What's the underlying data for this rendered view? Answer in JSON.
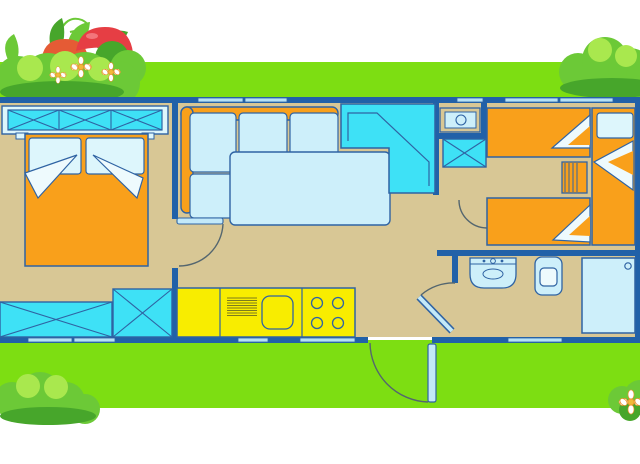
{
  "scene": {
    "kind": "cartoon-floorplan-illustration",
    "subject": "mobile-home-holiday-accommodation-plan",
    "canvas": {
      "width": 640,
      "height": 464
    }
  },
  "colors": {
    "background": "#ffffff",
    "grass": "#7dde12",
    "floor": "#d8c795",
    "wall": "#2161a8",
    "outline": "#2f63a3",
    "orange": "#f9a01b",
    "cyan": "#3ee1f6",
    "softcyan": "#cdeffa",
    "pillow": "#ddf6fc",
    "blanket": "#eefafd",
    "yellow": "#f8ed00",
    "window": "#b5e2f6",
    "doorleaf": "#c3e9f8",
    "arc": "#54666f",
    "drainer": "#7c7c1e",
    "bushdark": "#47a62b",
    "bushmid": "#6cc937",
    "bushlight": "#a9e84e",
    "mushred": "#e63e44",
    "mushred2": "#e55b35",
    "mushstem": "#f2ecca",
    "daisycenter": "#f0b93b",
    "daisyring": "#e8912b",
    "white": "#ffffff"
  },
  "legend": {
    "rooms": [
      "double-bedroom",
      "living-room",
      "kitchen",
      "hallway",
      "bathroom",
      "twin-bedroom"
    ],
    "furniture": [
      "overhead-wardrobe",
      "double-bed",
      "pillows",
      "wardrobe-cabinets",
      "corner-sofa",
      "sofa-cushions",
      "dining-table",
      "angular-kitchen-unit",
      "water-heater-closet",
      "cross-cabinet",
      "kitchen-counter",
      "drainer",
      "kitchen-sink",
      "hob-burners",
      "washbasin",
      "toilet",
      "shower",
      "twin-beds",
      "nightstand",
      "entry-door",
      "interior-doors",
      "windows"
    ],
    "decorations": [
      "bushes",
      "daisies",
      "mushrooms",
      "vine-tendril",
      "grass-bands"
    ]
  }
}
